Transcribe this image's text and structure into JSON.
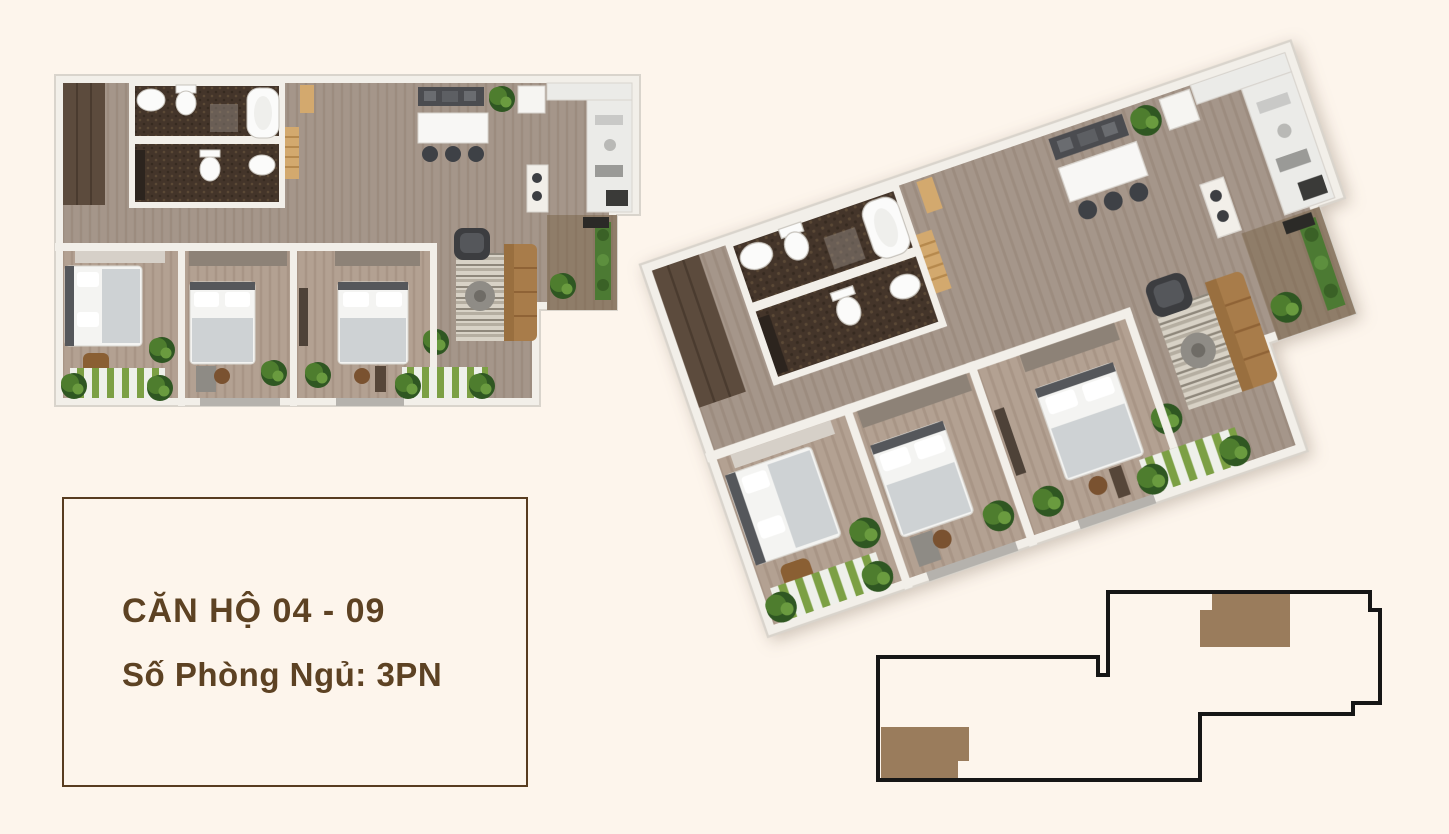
{
  "page": {
    "background_color": "#fdf5ec",
    "width": 1449,
    "height": 834
  },
  "info_card": {
    "title": "CĂN HỘ 04 - 09",
    "subtitle": "Số Phòng Ngủ: 3PN",
    "text_color": "#5d4223",
    "border_color": "#583c20"
  },
  "floor_plans": {
    "plan_2d": {
      "name": "2d-top-down-floor-plan",
      "bedroom_count": 3,
      "bathroom_count": 2,
      "balcony_count": 2
    },
    "plan_3d": {
      "name": "3d-isometric-floor-plan",
      "rotation_deg": -19
    }
  },
  "building_locator": {
    "outline_color": "#161616",
    "highlight_color": "#9a7c5c",
    "highlighted_units": [
      "04",
      "09"
    ]
  }
}
